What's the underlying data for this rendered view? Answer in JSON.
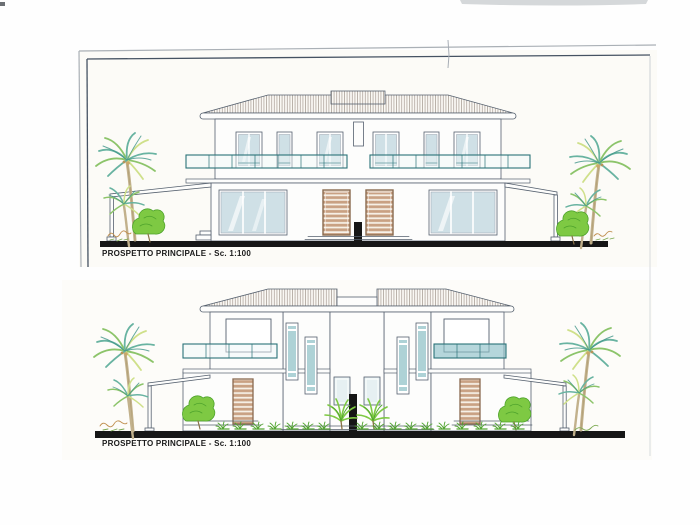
{
  "document": {
    "type": "scanned architectural elevation drawings",
    "sheets": [
      {
        "id": "top",
        "caption": "PROSPETTO PRINCIPALE - Sc. 1:100"
      },
      {
        "id": "bottom",
        "caption": "PROSPETTO PRINCIPALE - Sc. 1:100"
      }
    ]
  },
  "colors": {
    "paper": "#fcfbf7",
    "ink": "#55606e",
    "ink_light": "#98a0ac",
    "frame_outer": "#aab0b6",
    "frame_inner": "#455262",
    "roof_hatch": "#8d8076",
    "glass_blue": "#cfe0e6",
    "glass_deep": "#aed2d6",
    "railing_teal": "#2a7278",
    "balcony_fill": "#8fc2c9",
    "door_brown": "#8a6a4f",
    "door_fill": "#c9a183",
    "door_stripe": "#f6f0e6",
    "palm_teal": "#68b3a1",
    "palm_green": "#8cc46a",
    "palm_yellow": "#cfe08a",
    "palm_dark": "#3f9488",
    "bush_green": "#7ec943",
    "bush_dark": "#4ea32c",
    "trunk": "#c2b18c",
    "ground_black": "#161616",
    "label_black": "#1b1b1b"
  }
}
